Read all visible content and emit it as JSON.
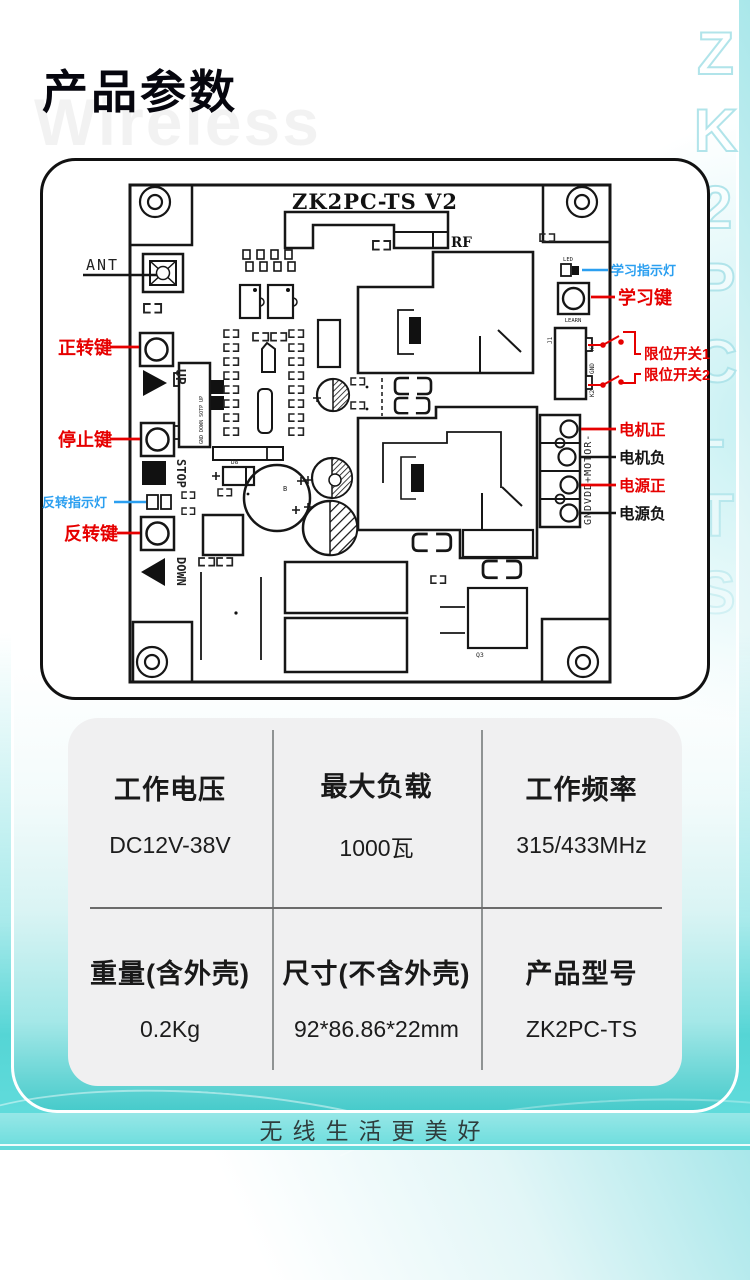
{
  "page": {
    "title": "产品参数",
    "watermark": "Wireless",
    "side_mark": "ZK2PC-TS",
    "slogan": "无线生活更美好",
    "colors": {
      "label_red": "#e60000",
      "label_blue": "#2b9ff0",
      "teal": "#46cbcb"
    }
  },
  "board": {
    "silk": {
      "model": "ZK2PC-TS V2",
      "rf": "RF",
      "ant": "ANT",
      "led": "LED",
      "learn": "LEARN",
      "up": "UP",
      "stop": "STOP",
      "down": "DOWN",
      "conn_left": "GND DOWN SOTP UP",
      "j1": "J1",
      "k1": "K1",
      "gnd": "GND",
      "k2": "K2",
      "terminal": "GNDVDD+MOTOR-",
      "q3": "Q3",
      "b": "B",
      "d8": "D8"
    },
    "callouts": {
      "forward_key": "正转键",
      "stop_key": "停止键",
      "reverse_indicator": "反转指示灯",
      "reverse_key": "反转键",
      "learn_indicator": "学习指示灯",
      "learn_key": "学习键",
      "limit_switch_1": "限位开关1",
      "limit_switch_2": "限位开关2",
      "motor_positive": "电机正",
      "motor_negative": "电机负",
      "power_positive": "电源正",
      "power_negative": "电源负"
    }
  },
  "specs": {
    "rows": [
      [
        {
          "label": "工作电压",
          "value": "DC12V-38V"
        },
        {
          "label": "最大负载",
          "value": "1000瓦"
        },
        {
          "label": "工作频率",
          "value": "315/433MHz"
        }
      ],
      [
        {
          "label": "重量(含外壳)",
          "value": "0.2Kg"
        },
        {
          "label": "尺寸(不含外壳)",
          "value": "92*86.86*22mm"
        },
        {
          "label": "产品型号",
          "value": "ZK2PC-TS"
        }
      ]
    ]
  }
}
